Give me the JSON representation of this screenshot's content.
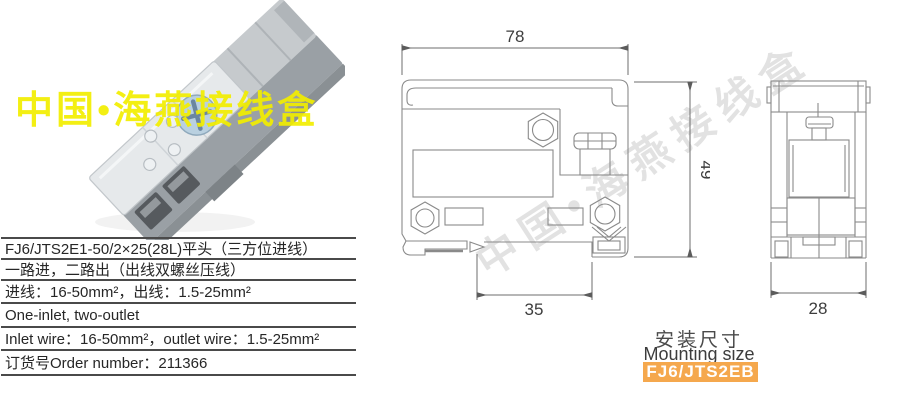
{
  "watermark": {
    "photo_text": "中国•海燕接线盒",
    "diagonal_text": "中国•海燕接线盒",
    "photo_color": "#f2ee00",
    "diagonal_color": "#9e9e9e"
  },
  "spec_table": {
    "rows": [
      "FJ6/JTS2E1-50/2×25(28L)平头（三方位进线）",
      "一路进，二路出（出线双螺丝压线）",
      "进线：16-50mm²，出线：1.5-25mm²",
      "One-inlet, two-outlet",
      "Inlet wire：16-50mm²，outlet wire：1.5-25mm²",
      "订货号Order number：211366"
    ]
  },
  "drawings": {
    "front_view": {
      "dim_width": "78",
      "dim_height": "49",
      "dim_rail": "35"
    },
    "side_view": {
      "dim_width": "28"
    }
  },
  "mounting": {
    "title_cn": "安装尺寸",
    "title_en": "Mounting size",
    "model": "FJ6/JTS2EB",
    "badge_color": "#f5a84d"
  }
}
